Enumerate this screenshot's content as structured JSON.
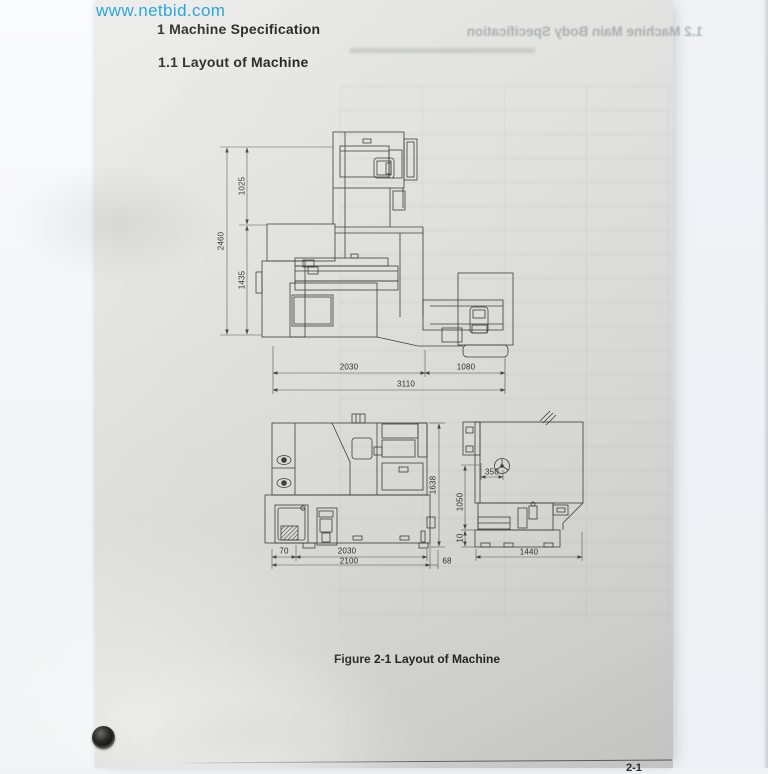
{
  "watermark": {
    "text": "www.netbid.com",
    "color": "#2ba6dc"
  },
  "page": {
    "heading1": "1 Machine Specification",
    "heading2": "1.1 Layout of Machine",
    "caption": "Figure 2-1 Layout of Machine",
    "page_number": "2-1",
    "bleed_text": "1.2 Machine Main Body Specification"
  },
  "drawing": {
    "side_elevation": {
      "dim_1025": "1025",
      "dim_2460": "2460",
      "dim_1435": "1435",
      "dim_2030": "2030",
      "dim_1080": "1080",
      "dim_3110": "3110"
    },
    "front_view": {
      "dim_1638": "1638",
      "dim_70": "70",
      "dim_2030": "2030",
      "dim_2100": "2100",
      "dim_68": "68"
    },
    "right_view": {
      "dim_350": "350",
      "dim_1050": "1050",
      "dim_10": "10",
      "dim_1440": "1440"
    }
  }
}
